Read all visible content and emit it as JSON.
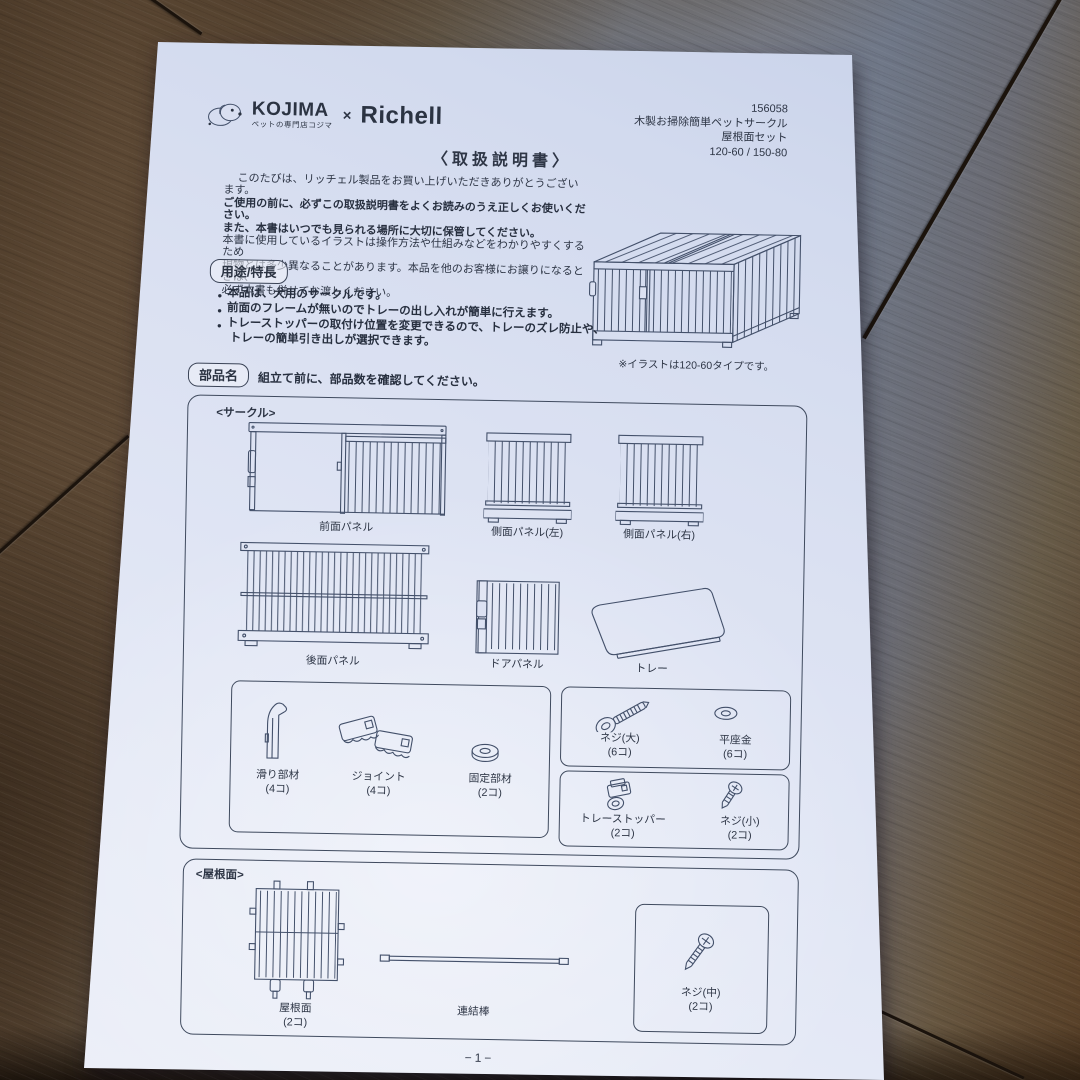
{
  "header": {
    "logo": {
      "kojima": "KOJIMA",
      "kojima_sub": "ペットの専門店コジマ",
      "cross": "×",
      "richell": "Richell"
    },
    "product": {
      "code": "156058",
      "name": "木製お掃除簡単ペットサークル",
      "set": "屋根面セット",
      "sizes": "120-60 / 150-80"
    }
  },
  "title": "〈取扱説明書〉",
  "intro": {
    "l1": "このたびは、リッチェル製品をお買い上げいただきありがとうございます。",
    "l2": "ご使用の前に、必ずこの取扱説明書をよくお読みのうえ正しくお使いください。",
    "l3": "また、本書はいつでも見られる場所に大切に保管してください。",
    "l4": "本書に使用しているイラストは操作方法や仕組みなどをわかりやすくするため",
    "l5": "現物とは多少異なることがあります。本品を他のお客様にお譲りになるときは、",
    "l6": "必ず本書も併せてお渡しください。"
  },
  "illustration_note": "※イラストは120-60タイプです。",
  "glyph": {
    "bullet": "●"
  },
  "features": {
    "heading": "用途/特長",
    "b1": "本品は、犬用のサークルです。",
    "b2": "前面のフレームが無いのでトレーの出し入れが簡単に行えます。",
    "b3": "トレーストッパーの取付け位置を変更できるので、トレーのズレ防止や、",
    "b3b": "トレーの簡単引き出しが選択できます。"
  },
  "parts": {
    "heading": "部品名",
    "instruction": "組立て前に、部品数を確認してください。",
    "circle": {
      "label": "<サークル>",
      "front_panel": "前面パネル",
      "side_left": "側面パネル(左)",
      "side_right": "側面パネル(右)",
      "back_panel": "後面パネル",
      "door_panel": "ドアパネル",
      "tray": "トレー",
      "slider": {
        "name": "滑り部材",
        "count": "(4コ)"
      },
      "joint": {
        "name": "ジョイント",
        "count": "(4コ)"
      },
      "fixing": {
        "name": "固定部材",
        "count": "(2コ)"
      },
      "screw_large": {
        "name": "ネジ(大)",
        "count": "(6コ)"
      },
      "washer": {
        "name": "平座金",
        "count": "(6コ)"
      },
      "tray_stopper": {
        "name": "トレーストッパー",
        "count": "(2コ)"
      },
      "screw_small": {
        "name": "ネジ(小)",
        "count": "(2コ)"
      }
    },
    "roof": {
      "label": "<屋根面>",
      "roof_panel": {
        "name": "屋根面",
        "count": "(2コ)"
      },
      "rod": {
        "name": "連結棒"
      },
      "screw_medium": {
        "name": "ネジ(中)",
        "count": "(2コ)"
      }
    }
  },
  "footer": {
    "page_number": "−1−"
  },
  "colors": {
    "paper": "#dbe1f2",
    "ink": "#2e3646",
    "wood_dark": "#2b1d12",
    "wood_light": "#7a8192"
  }
}
